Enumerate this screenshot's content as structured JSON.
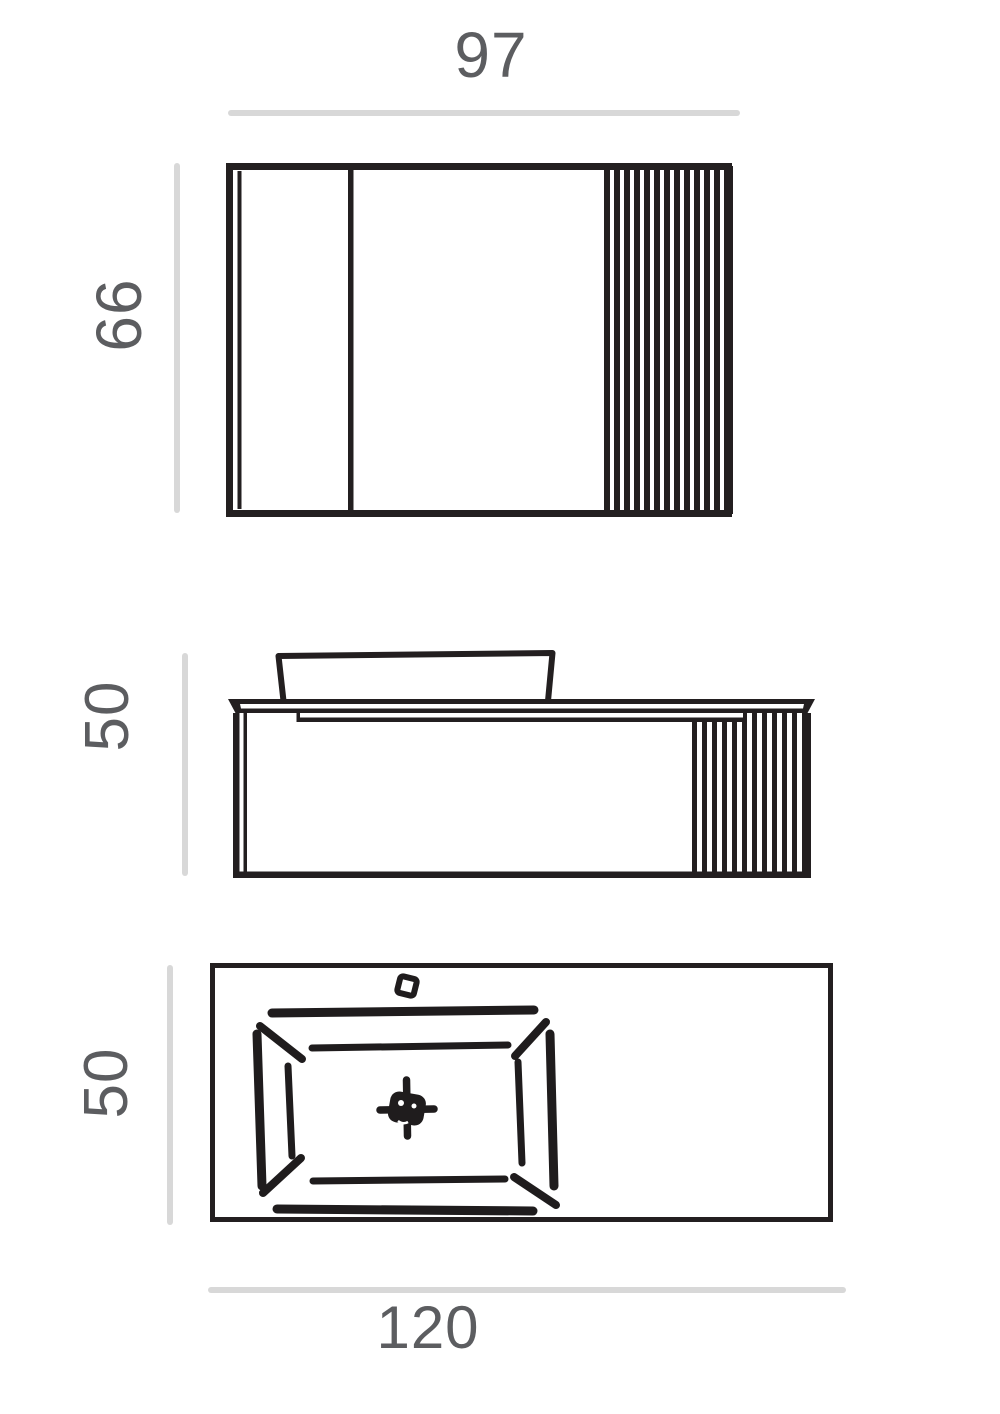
{
  "document": {
    "type": "technical-dimension-drawing",
    "background": "#ffffff"
  },
  "colors": {
    "line_black": "#231f20",
    "dimension_line_gray": "#d8d8d8",
    "label_text_gray": "#5c5d60"
  },
  "dimensions": {
    "mirror_width": "97",
    "mirror_height": "66",
    "vanity_height": "50",
    "countertop_depth": "50",
    "countertop_width": "120"
  }
}
